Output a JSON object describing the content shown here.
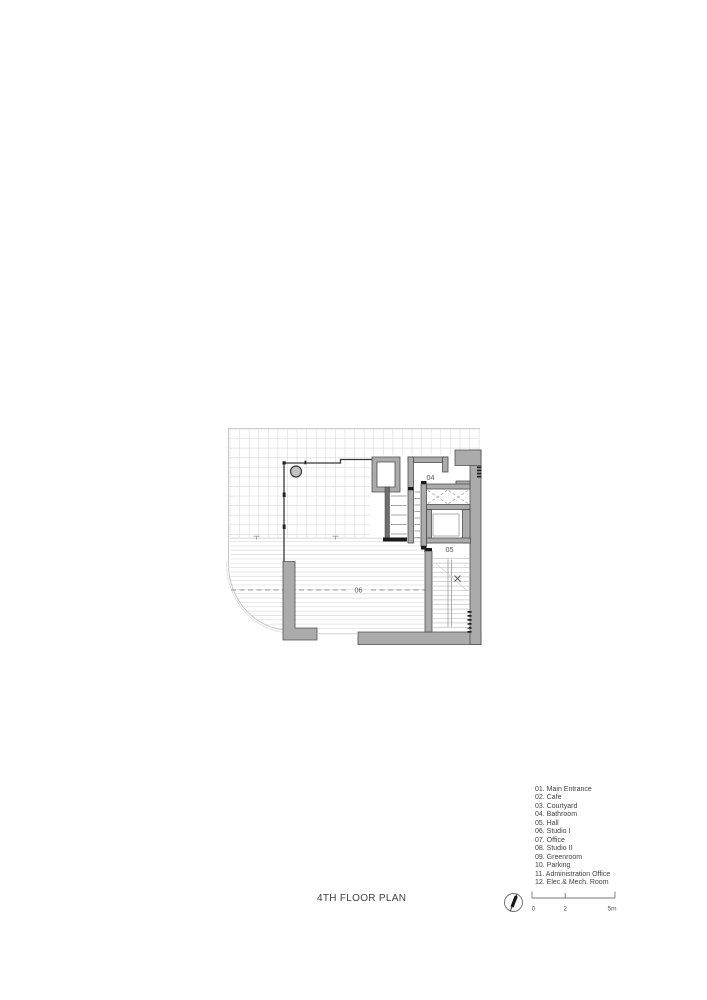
{
  "title": {
    "text": "4TH FLOOR PLAN"
  },
  "legend": {
    "items": [
      "01. Main Entrance",
      "02. Cafe",
      "03. Courtyard",
      "04. Bathroom",
      "05. Hall",
      "06. Studio I",
      "07. Office",
      "08. Studio II",
      "09. Greenroom",
      "10. Parking",
      "11. Administration Office",
      "12. Elec.& Mech. Room"
    ]
  },
  "plan": {
    "room_labels": {
      "bathroom": "04",
      "hall": "05",
      "studio_1": "06"
    }
  },
  "scale_bar": {
    "labels": [
      "0",
      "2",
      "5m"
    ]
  },
  "icons": {
    "north_arrow": "north-arrow"
  },
  "colors": {
    "wall_fill": "#ababab",
    "wall_stroke": "#4e4e4e",
    "grid_line": "#dedede",
    "deck_line": "#e0e0e0",
    "dashed_line": "#9c9c9c",
    "black_detail": "#1a1a1a",
    "text": "#3f3f3f"
  }
}
